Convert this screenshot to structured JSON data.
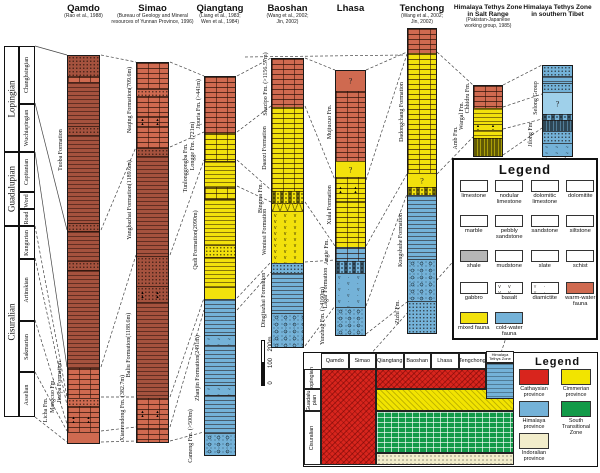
{
  "colors": {
    "warm": "#cf6a50",
    "warmdark": "#a5523e",
    "yellow": "#f2e10c",
    "blue": "#74b2d8",
    "bluelight": "#9fd0ea",
    "cathaysian": "#d8251d",
    "cimmerian": "#f2e400",
    "himalaya": "#74b2d8",
    "south_tz": "#129a48",
    "indoralian": "#f2edcb"
  },
  "timescale": {
    "series": [
      {
        "label": "Lopingian",
        "h": 106,
        "stages": [
          {
            "label": "Changhsingian",
            "h": 58
          },
          {
            "label": "Wuchiapingian",
            "h": 48
          }
        ]
      },
      {
        "label": "Guadalupian",
        "h": 74,
        "stages": [
          {
            "label": "Capitanian",
            "h": 40
          },
          {
            "label": "Word",
            "h": 17
          },
          {
            "label": "Road",
            "h": 17
          }
        ]
      },
      {
        "label": "Cisuralian",
        "h": 191,
        "stages": [
          {
            "label": "Kungurian",
            "h": 33
          },
          {
            "label": "Artinskian",
            "h": 62
          },
          {
            "label": "Sakmarian",
            "h": 51
          },
          {
            "label": "Asselian",
            "h": 45
          }
        ]
      }
    ]
  },
  "columns": [
    {
      "name": [
        "Qamdo"
      ],
      "citation": [
        "(Rao et al., 1988)"
      ],
      "x": 67,
      "w": 33,
      "top": 55,
      "sections": [
        {
          "h": 20,
          "c": "warmdark",
          "p": "dots"
        },
        {
          "h": 6,
          "c": "warm",
          "p": "brick"
        },
        {
          "h": 44,
          "c": "warmdark",
          "p": "lines"
        },
        {
          "h": 9,
          "c": "warmdark",
          "p": "dots"
        },
        {
          "h": 88,
          "c": "warmdark",
          "p": "lines"
        },
        {
          "h": 8,
          "c": "warmdark",
          "p": "dots"
        },
        {
          "h": 30,
          "c": "warmdark",
          "p": "lines"
        },
        {
          "h": 9,
          "c": "warmdark",
          "p": "dots"
        },
        {
          "h": 98,
          "c": "warmdark",
          "p": "lines"
        },
        {
          "h": 30,
          "c": "warm",
          "p": "brick"
        },
        {
          "h": 8,
          "c": "warm",
          "p": "dots"
        },
        {
          "h": 26,
          "c": "warm",
          "p": "brick-tri"
        },
        {
          "h": 11,
          "c": "warm",
          "p": "plain"
        }
      ],
      "labels": [
        {
          "t": "Tuoba Formation",
          "x": 61,
          "y": 150
        },
        {
          "t": "Jiaopa Formation",
          "x": 60,
          "y": 382
        },
        {
          "t": "Mangcuo Fm.",
          "x": 53,
          "y": 396
        },
        {
          "t": "Licha Fm.",
          "x": 46,
          "y": 410
        }
      ]
    },
    {
      "name": [
        "Simao"
      ],
      "citation": [
        "(Bureau of Geology and Mineral",
        "resources of Yunnan Province, 1996)"
      ],
      "x": 136,
      "w": 33,
      "top": 62,
      "sections": [
        {
          "h": 26,
          "c": "warm",
          "p": "brick"
        },
        {
          "h": 7,
          "c": "warm",
          "p": "dots"
        },
        {
          "h": 20,
          "c": "warm",
          "p": "brick"
        },
        {
          "h": 10,
          "c": "warm",
          "p": "brick-tri"
        },
        {
          "h": 22,
          "c": "warm",
          "p": "brick"
        },
        {
          "h": 8,
          "c": "warmdark",
          "p": "dots"
        },
        {
          "h": 100,
          "c": "warmdark",
          "p": "lines"
        },
        {
          "h": 30,
          "c": "warmdark",
          "p": "dots"
        },
        {
          "h": 16,
          "c": "warmdark",
          "p": "dots-tri"
        },
        {
          "h": 96,
          "c": "warmdark",
          "p": "lines"
        },
        {
          "h": 30,
          "c": "warm",
          "p": "brick-tri"
        },
        {
          "h": 14,
          "c": "warm",
          "p": "brick"
        }
      ],
      "labels": [
        {
          "t": "Naqing Formation(709.6m)",
          "x": 130,
          "y": 100
        },
        {
          "t": "Yangbazhai Formation(1189.6m)",
          "x": 130,
          "y": 200
        },
        {
          "t": "Baliu Formation(1188.6m)",
          "x": 129,
          "y": 345
        },
        {
          "t": "Xianrendong Fm. (382.7m)",
          "x": 123,
          "y": 408
        }
      ]
    },
    {
      "name": [
        "Qiangtang"
      ],
      "citation": [
        "(Liang et al., 1983;",
        "Wen et al., 1984)"
      ],
      "x": 204,
      "w": 32,
      "top": 76,
      "sections": [
        {
          "h": 56,
          "c": "warm",
          "p": "brick"
        },
        {
          "h": 28,
          "c": "yellow",
          "p": "brick"
        },
        {
          "h": 26,
          "c": "yellow",
          "p": "lines"
        },
        {
          "h": 12,
          "c": "yellow",
          "p": "brick"
        },
        {
          "h": 46,
          "c": "yellow",
          "p": "lines"
        },
        {
          "h": 12,
          "c": "yellow",
          "p": "dots"
        },
        {
          "h": 30,
          "c": "yellow",
          "p": "lines"
        },
        {
          "h": 12,
          "c": "yellow",
          "p": "plain"
        },
        {
          "h": 36,
          "c": "blue",
          "p": "lines"
        },
        {
          "h": 10,
          "c": "blue",
          "p": "wavy"
        },
        {
          "h": 40,
          "c": "blue",
          "p": "lines"
        },
        {
          "h": 10,
          "c": "blue",
          "p": "wavy"
        },
        {
          "h": 38,
          "c": "blue",
          "p": "lines"
        },
        {
          "h": 22,
          "c": "blue",
          "p": "pebbly"
        }
      ],
      "labels": [
        {
          "t": "Jipuria Fm. (>441m)",
          "x": 199,
          "y": 104
        },
        {
          "t": "Longge Fm. (721m)",
          "x": 193,
          "y": 146
        },
        {
          "t": "Tunlonggongba Fm.",
          "x": 186,
          "y": 168
        },
        {
          "t": "Qudi Formation(2090m)",
          "x": 196,
          "y": 240
        },
        {
          "t": "Zhanjin Formation(2491m)",
          "x": 198,
          "y": 368
        },
        {
          "t": "Cameng Fm. (>500m)",
          "x": 191,
          "y": 436
        }
      ]
    },
    {
      "name": [
        "Baoshan"
      ],
      "citation": [
        "(Wang et al., 2002;",
        "Jin, 2002)"
      ],
      "x": 271,
      "w": 33,
      "top": 58,
      "sections": [
        {
          "h": 48,
          "c": "warm",
          "p": "brick"
        },
        {
          "h": 84,
          "c": "yellow",
          "p": "brick"
        },
        {
          "h": 12,
          "c": "yellow",
          "p": "nodular"
        },
        {
          "h": 8,
          "c": "yellow",
          "p": "cross"
        },
        {
          "h": 52,
          "c": "yellow",
          "p": "basalt"
        },
        {
          "h": 10,
          "c": "blue",
          "p": "dots"
        },
        {
          "h": 40,
          "c": "blue",
          "p": "lines"
        },
        {
          "h": 34,
          "c": "blue",
          "p": "pebbly"
        }
      ],
      "labels": [
        {
          "t": "Shazipo Fm. (>1156.57m)",
          "x": 266,
          "y": 84
        },
        {
          "t": "Daaozi Formation",
          "x": 265,
          "y": 148
        },
        {
          "t": "Bingma Fm.",
          "x": 261,
          "y": 198
        },
        {
          "t": "Woniusi Formation",
          "x": 265,
          "y": 232
        },
        {
          "t": "Dingjiazhai Formation",
          "x": 264,
          "y": 300
        }
      ]
    },
    {
      "name": [
        "Lhasa"
      ],
      "citation": [],
      "x": 335,
      "w": 31,
      "top": 70,
      "sections": [
        {
          "h": 20,
          "c": "warm",
          "p": "plain",
          "q": true
        },
        {
          "h": 70,
          "c": "warm",
          "p": "brick"
        },
        {
          "h": 16,
          "c": "yellow",
          "p": "plain",
          "q": true
        },
        {
          "h": 24,
          "c": "yellow",
          "p": "brick-tri"
        },
        {
          "h": 46,
          "c": "yellow",
          "p": "brick"
        },
        {
          "h": 14,
          "c": "blue",
          "p": "brick"
        },
        {
          "h": 12,
          "c": "blue",
          "p": "nodular"
        },
        {
          "h": 34,
          "c": "blue",
          "p": "diamict"
        },
        {
          "h": 28,
          "c": "blue",
          "p": "pebbly"
        }
      ],
      "labels": [
        {
          "t": "Mujiucuo Fm.",
          "x": 330,
          "y": 122
        },
        {
          "t": "Xiala Formation",
          "x": 330,
          "y": 205
        },
        {
          "t": "Angie Fm.",
          "x": 327,
          "y": 252
        },
        {
          "t": "Lagar Formation",
          "x": 326,
          "y": 288
        },
        {
          "t": "Yunzhug Fm. (>4160m)",
          "x": 323,
          "y": 316
        }
      ]
    },
    {
      "name": [
        "Tenchong"
      ],
      "citation": [
        "(Wang et al., 2002;",
        "Jin, 2002)"
      ],
      "x": 407,
      "w": 30,
      "top": 28,
      "sections": [
        {
          "h": 24,
          "c": "warm",
          "p": "brick"
        },
        {
          "h": 120,
          "c": "yellow",
          "p": "brick"
        },
        {
          "h": 14,
          "c": "yellow",
          "p": "plain",
          "q": true
        },
        {
          "h": 8,
          "c": "yellow",
          "p": "nodular"
        },
        {
          "h": 64,
          "c": "blue",
          "p": "lines"
        },
        {
          "h": 42,
          "c": "blue",
          "p": "pebbly"
        },
        {
          "h": 32,
          "c": "blue",
          "p": "dots"
        }
      ],
      "labels": [
        {
          "t": "Dadongchang Formation",
          "x": 402,
          "y": 112
        },
        {
          "t": "Kongshuhe Formation",
          "x": 401,
          "y": 240
        },
        {
          "t": "Zizhi Fm.",
          "x": 398,
          "y": 312
        }
      ]
    },
    {
      "name": [
        "Himalaya Tethys Zone",
        "in Salt Range"
      ],
      "small_name": true,
      "citation": [
        "(Pakistan-Japanese",
        "working group, 1985)"
      ],
      "x": 473,
      "w": 30,
      "top": 85,
      "sections": [
        {
          "h": 22,
          "c": "warm",
          "p": "brick"
        },
        {
          "h": 16,
          "c": "yellow",
          "p": "lines"
        },
        {
          "h": 6,
          "c": "yellow",
          "p": "tri"
        },
        {
          "h": 8,
          "c": "yellow",
          "p": "lines"
        },
        {
          "h": 18,
          "c": "yellow",
          "p": "dashes"
        }
      ],
      "labels": [
        {
          "t": "Chhidru Fm.",
          "x": 468,
          "y": 98
        },
        {
          "t": "Wargal Fm.",
          "x": 462,
          "y": 116
        },
        {
          "t": "Amb Fm.",
          "x": 456,
          "y": 138
        }
      ]
    },
    {
      "name": [
        "Himalaya Tethys Zone",
        "in southern Tibet"
      ],
      "small_name": true,
      "citation": [],
      "x": 542,
      "w": 31,
      "top": 65,
      "sections": [
        {
          "h": 10,
          "c": "blue",
          "p": "dots"
        },
        {
          "h": 7,
          "c": "blue",
          "p": "lines"
        },
        {
          "h": 9,
          "c": "blue",
          "p": "dots"
        },
        {
          "h": 22,
          "c": "bluelight",
          "p": "plain",
          "q": true
        },
        {
          "h": 6,
          "c": "blue",
          "p": "nodular"
        },
        {
          "h": 11,
          "c": "blue",
          "p": "dashes"
        },
        {
          "h": 12,
          "c": "blue",
          "p": "dots"
        },
        {
          "h": 13,
          "c": "blue",
          "p": "wavy"
        }
      ],
      "labels": [
        {
          "t": "Selong Group",
          "x": 536,
          "y": 98
        },
        {
          "t": "Jilong Fm.",
          "x": 531,
          "y": 134
        }
      ]
    }
  ],
  "scale_bar": {
    "labels": [
      {
        "t": "200m",
        "y": 344
      },
      {
        "t": "100",
        "y": 363
      },
      {
        "t": "0",
        "y": 383
      }
    ]
  },
  "legend": {
    "title": "Legend",
    "items": [
      {
        "label": "limestone",
        "p": "brick"
      },
      {
        "label": "nodular limestone",
        "p": "nodular"
      },
      {
        "label": "dolomitic limestone",
        "p": "brickdiag"
      },
      {
        "label": "dolomitite",
        "p": "diag"
      },
      {
        "label": "marble",
        "p": "marble"
      },
      {
        "label": "pebbly sandstone",
        "p": "pebbly"
      },
      {
        "label": "sandstone",
        "p": "dots"
      },
      {
        "label": "siltstone",
        "p": "silt"
      },
      {
        "label": "shale",
        "p": "shale"
      },
      {
        "label": "mudstone",
        "p": "dashes"
      },
      {
        "label": "slate",
        "p": "slate"
      },
      {
        "label": "schist",
        "p": "schist"
      },
      {
        "label": "gabbro",
        "p": "gabbro"
      },
      {
        "label": "basalt",
        "p": "basalt"
      },
      {
        "label": "diamictite",
        "p": "diamict"
      },
      {
        "label": "warm-water fauna",
        "p": "plain",
        "color": "warm"
      },
      {
        "label": "mixed fauna",
        "p": "plain",
        "color": "yellow"
      },
      {
        "label": "cold-water fauna",
        "p": "plain",
        "color": "blue"
      }
    ]
  },
  "province_panel": {
    "legend_title": "Legend",
    "columns": [
      "Qamdo",
      "Simao",
      "Qiangtang",
      "Baoshan",
      "Lhasa",
      "Tengchong"
    ],
    "himalaya_header": [
      "Himalaya",
      "Tethys Zone"
    ],
    "rows": [
      [
        "Lopingian"
      ],
      [
        "Guadalu-",
        "pian"
      ],
      [
        "Cisuralian"
      ]
    ],
    "provinces": [
      {
        "label": "Cathaysian province",
        "color": "cathaysian",
        "p": "hatch"
      },
      {
        "label": "Cimmerian province",
        "color": "cimmerian",
        "p": "hatch2"
      },
      {
        "label": "Himalaya province",
        "color": "himalaya",
        "p": "lines"
      },
      {
        "label": "South Transitional Zone",
        "color": "south_tz",
        "p": "grid"
      },
      {
        "label": "Indoralian province",
        "color": "indoralian",
        "p": "dots"
      }
    ],
    "regions": [
      {
        "province": 0,
        "x": 0,
        "y": 0,
        "w": 55,
        "h": 96
      },
      {
        "province": 0,
        "x": 55,
        "y": 0,
        "w": 110,
        "h": 20
      },
      {
        "province": 1,
        "x": 55,
        "y": 20,
        "w": 138,
        "h": 22
      },
      {
        "province": 3,
        "x": 55,
        "y": 42,
        "w": 138,
        "h": 42
      },
      {
        "province": 4,
        "x": 55,
        "y": 84,
        "w": 138,
        "h": 12
      },
      {
        "province": 2,
        "x": 165,
        "y": -6,
        "w": 28,
        "h": 36
      }
    ]
  }
}
